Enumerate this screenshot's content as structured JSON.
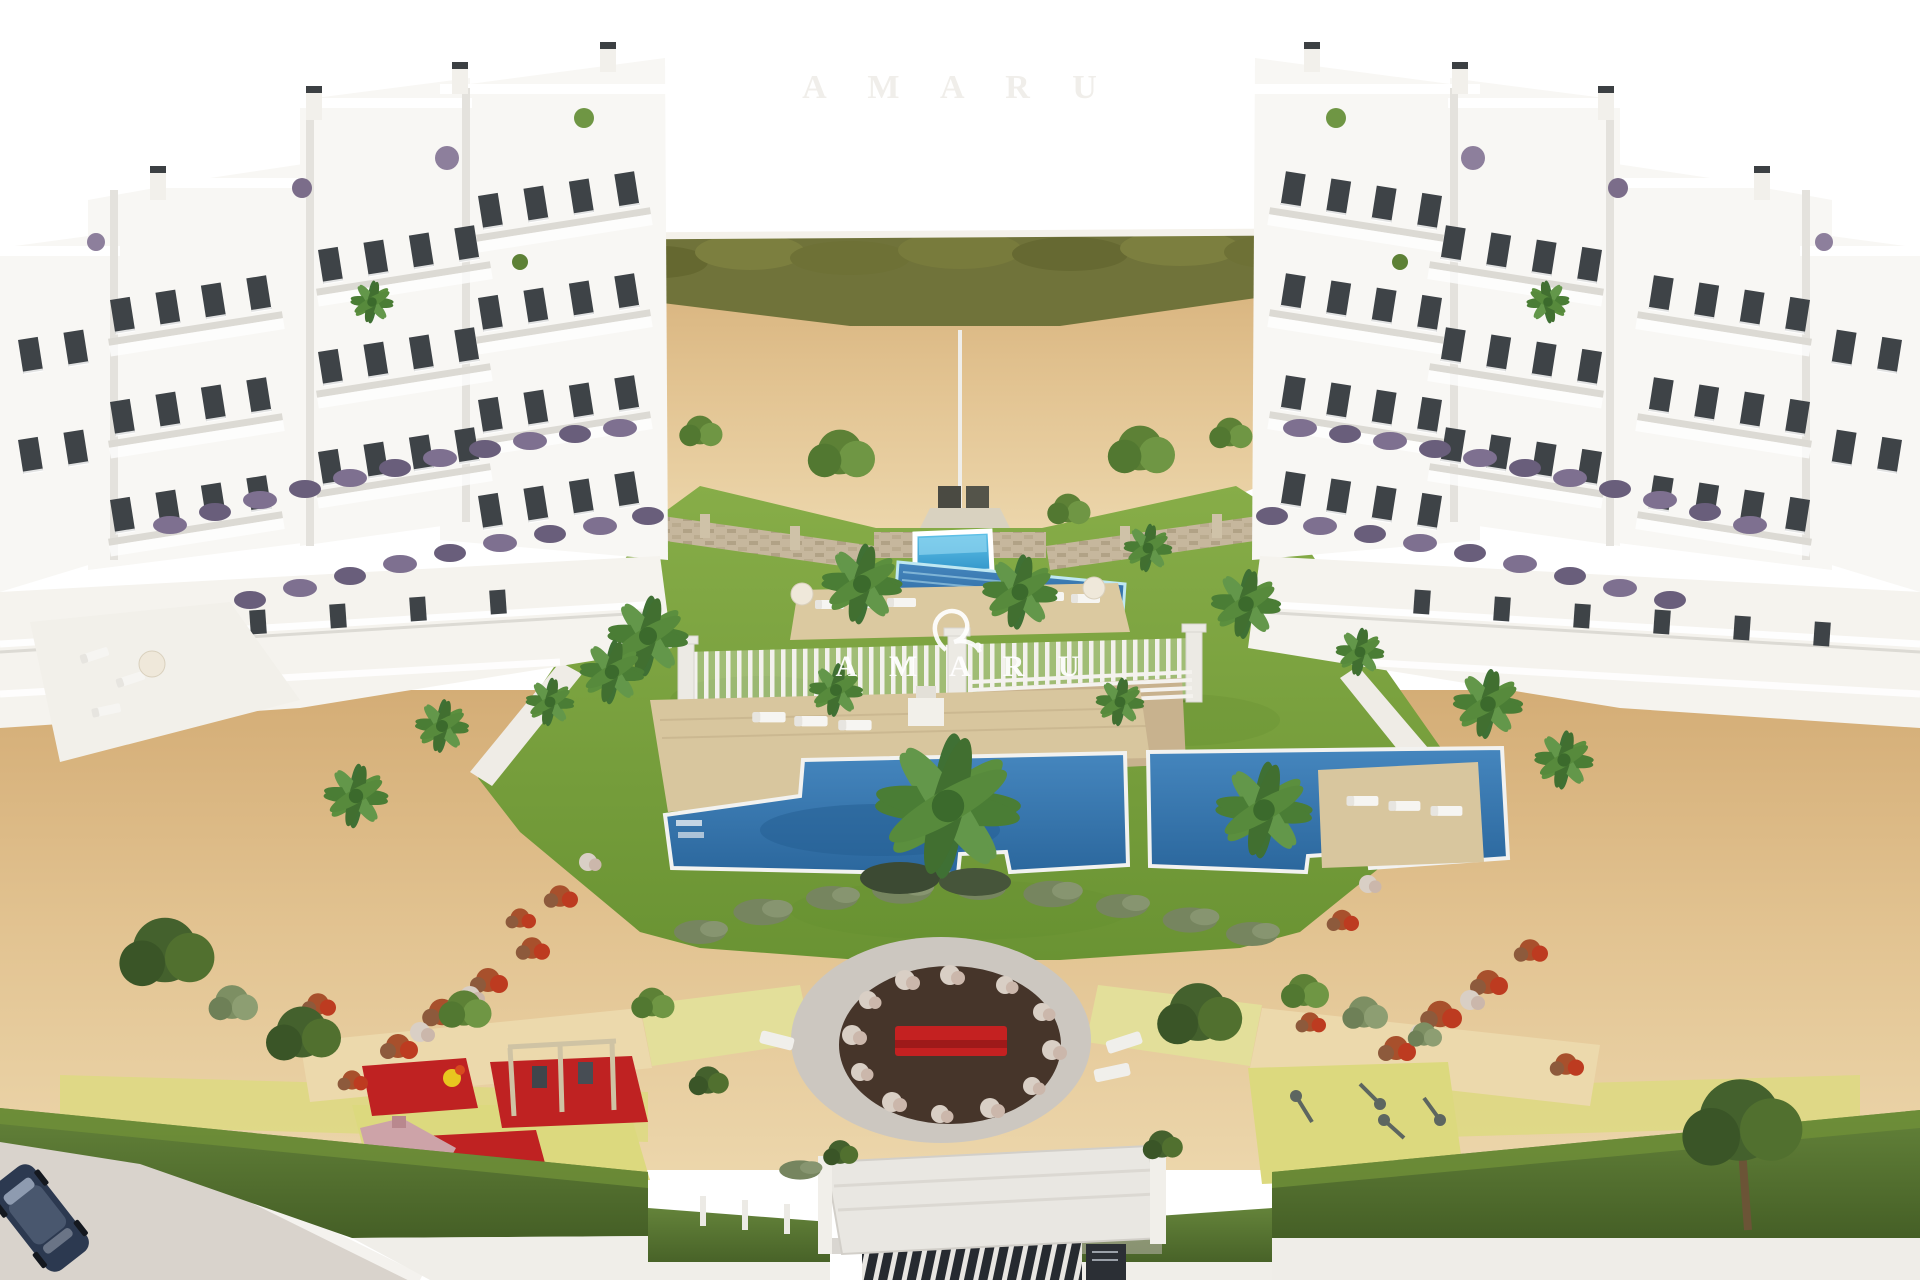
{
  "image": {
    "type": "architectural-aerial-render",
    "scene_description": "Aerial 3D rendering of a white Mediterranean apartment development with two stepped building clusters, communal lawns, kids pool, lap pool, two large swimming pools with wooden decks, pergola pool-house, palm trees, flowering shrubs, circular plaza with red bench, children's playground, outdoor gym area, perimeter hedges and a gated entrance with a parked car",
    "watermark": {
      "logo": "amaru-flourish-logo",
      "text": "A M A R U",
      "top_text": "A M A R U"
    },
    "colors": {
      "sky": "#ffffff",
      "sand": "#ddb987",
      "sand-light": "#ecd6ab",
      "hill": "#cda670",
      "hill-grass": "#70733a",
      "grass": "#7da33f",
      "grass-dark": "#63872f",
      "pool-main": "#3a79b0",
      "pool-bright": "#45b0e0",
      "pool-rim": "#f4f6f5",
      "deck": "#d8c69e",
      "stone": "#c6b79d",
      "shrub-purple": "#7e7090",
      "bush-gray": "#76855f",
      "flower-red": "#b34a2b",
      "flower-white": "#d9cfc5",
      "facade": "#f8f7f4",
      "facade-shade": "#e4e2dd",
      "window": "#3d4247",
      "hedge": "#55732c",
      "mat-red": "#bf2222",
      "mat-yellow": "#dcd97e",
      "plaza-ring": "#ccc7c0",
      "plaza-center": "#46352a",
      "bench-red": "#c42121",
      "road": "#d9d3cc",
      "car-navy": "#2c3950"
    }
  }
}
